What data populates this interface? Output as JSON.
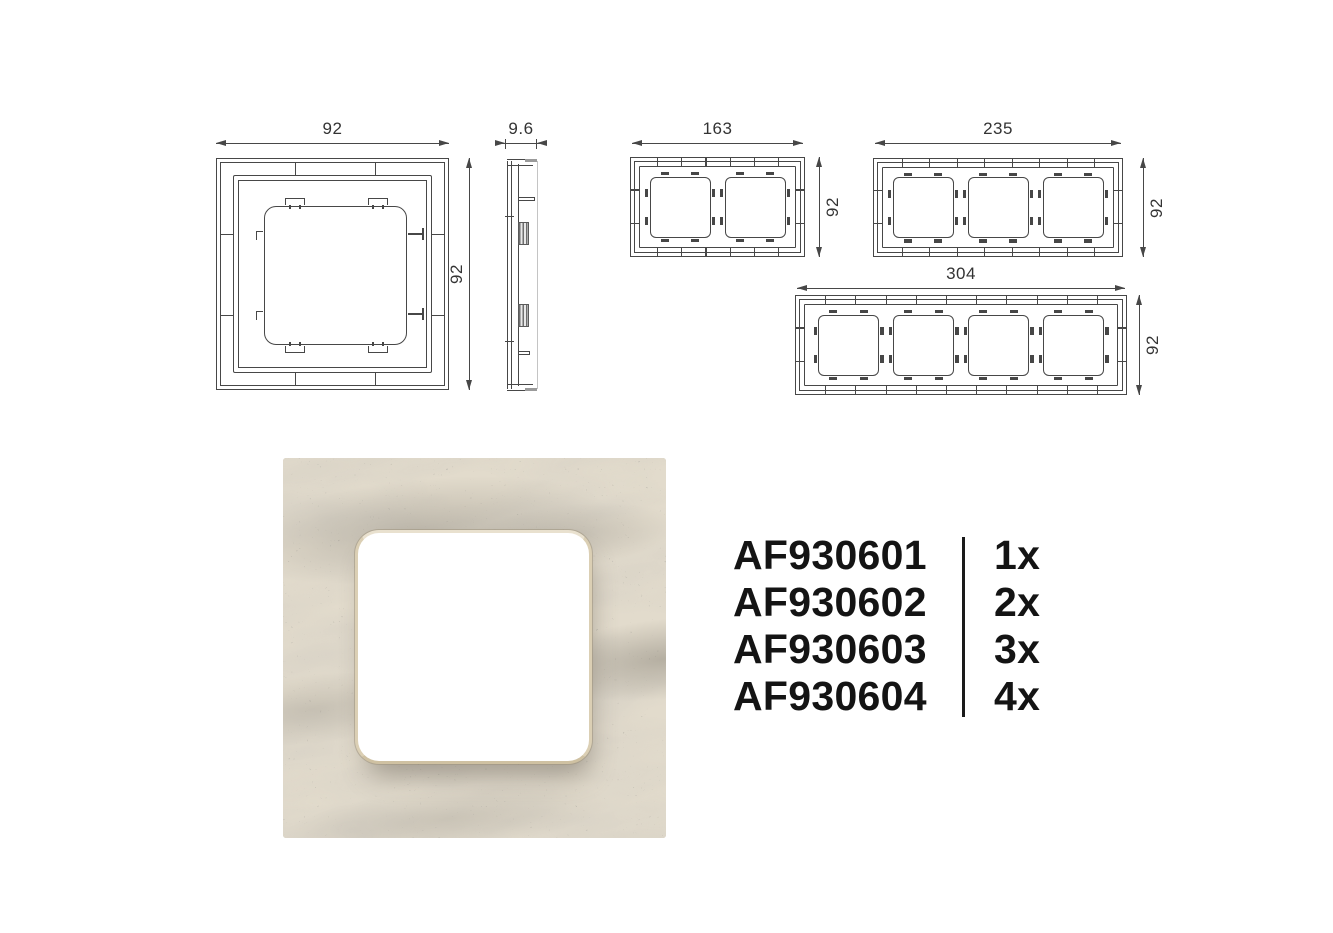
{
  "drawings": {
    "single_front": {
      "width_label": "92",
      "height_label": "92"
    },
    "side": {
      "depth_label": "9.6"
    },
    "two_gang": {
      "width_label": "163",
      "height_label": "92"
    },
    "three_gang": {
      "width_label": "235",
      "height_label": "92"
    },
    "four_gang": {
      "width_label": "304",
      "height_label": "92"
    }
  },
  "products": {
    "items": [
      {
        "code": "AF930601",
        "qty": "1x"
      },
      {
        "code": "AF930602",
        "qty": "2x"
      },
      {
        "code": "AF930603",
        "qty": "3x"
      },
      {
        "code": "AF930604",
        "qty": "4x"
      }
    ]
  },
  "colors": {
    "line": "#474747",
    "dim_text": "#333333",
    "text": "#141414",
    "marble_base": "#e2dbcc",
    "marble_vein": "#8f8b81",
    "cutout_ring": "#dbcfb4",
    "cutout_fill": "#ffffff",
    "page_bg": "#ffffff"
  }
}
